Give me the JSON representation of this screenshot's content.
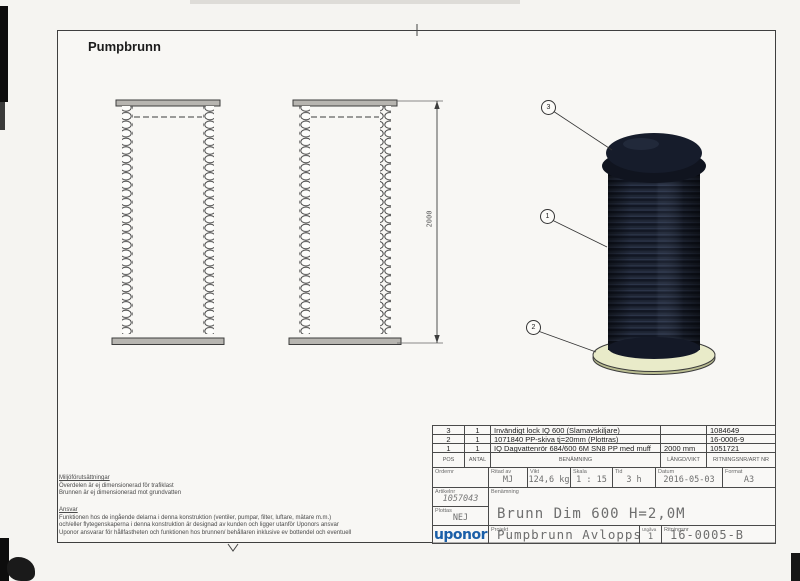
{
  "page": {
    "title": "Pumpbrunn"
  },
  "dimension": {
    "value": "2000"
  },
  "balloons": [
    {
      "n": "3"
    },
    {
      "n": "1"
    },
    {
      "n": "2"
    }
  ],
  "parts_table": {
    "headers": {
      "pos": "POS",
      "antal": "ANTAL",
      "benamning": "BENÄMNING",
      "langd_vikt": "LÄNGD/VIKT",
      "artnr": "RITNINGSNR/ART NR"
    },
    "rows": [
      {
        "pos": "3",
        "antal": "1",
        "benamning": "Invändigt lock IQ 600 (Slamavskiljare)",
        "langd_vikt": "",
        "artnr": "1084649"
      },
      {
        "pos": "2",
        "antal": "1",
        "benamning": "1071840  PP-skiva tj=20mm  (Plottras)",
        "langd_vikt": "",
        "artnr": "16-0006-9"
      },
      {
        "pos": "1",
        "antal": "1",
        "benamning": "IQ Dagvattenrör 684/600 6M SN8 PP med muff",
        "langd_vikt": "2000 mm",
        "artnr": "1051721"
      }
    ]
  },
  "title_block": {
    "order_label": "Ordernr",
    "ritad_av_label": "Ritad av",
    "ritad_av": "MJ",
    "vikt_label": "Vikt",
    "vikt": "124,6 kg",
    "skala_label": "Skala",
    "skala": "1 : 15",
    "tid_label": "Tid",
    "tid": "3 h",
    "datum_label": "Datum",
    "datum": "2016-05-03",
    "format_label": "Format",
    "format": "A3",
    "artnr_label": "Artikelnr",
    "artnr": "1057043",
    "plottas_label": "Plottas",
    "plottas": "NEJ",
    "benamning_label": "Benämning",
    "benamning": "Brunn Dim 600 H=2,0M",
    "logo": "uponor",
    "projekt_label": "Projekt",
    "projekt": "Pumpbrunn Avloppsprf",
    "utgava_label": "Utgåva",
    "utgava": "1",
    "ritningsnr_label": "Ritningsnr",
    "ritningsnr": "16-0005-B"
  },
  "notes": {
    "heading1": "Miljöförutsättningar",
    "line1a": "Överdelen är ej dimensionerad för trafiklast",
    "line1b": "Brunnen är ej dimensionerad mot grundvatten",
    "heading2": "Ansvar",
    "line2a": "Funktionen hos de ingående delarna i denna konstruktion (ventiler, pumpar, filter, luftare, mätare m.m.)",
    "line2b": "och/eller flytegenskaperna i denna konstruktion är designad av kunden och ligger utanför Uponors ansvar",
    "line2c": "Uponor ansvarar för hållfastheten och funktionen hos brunnen/ behållaren inklusive ev bottendel och eventuell"
  },
  "colors": {
    "logo_blue": "#1b5fa8",
    "cylinder_dark": "#1b2130",
    "base_disc": "#e9ebc9",
    "line": "#3d3d3d"
  }
}
